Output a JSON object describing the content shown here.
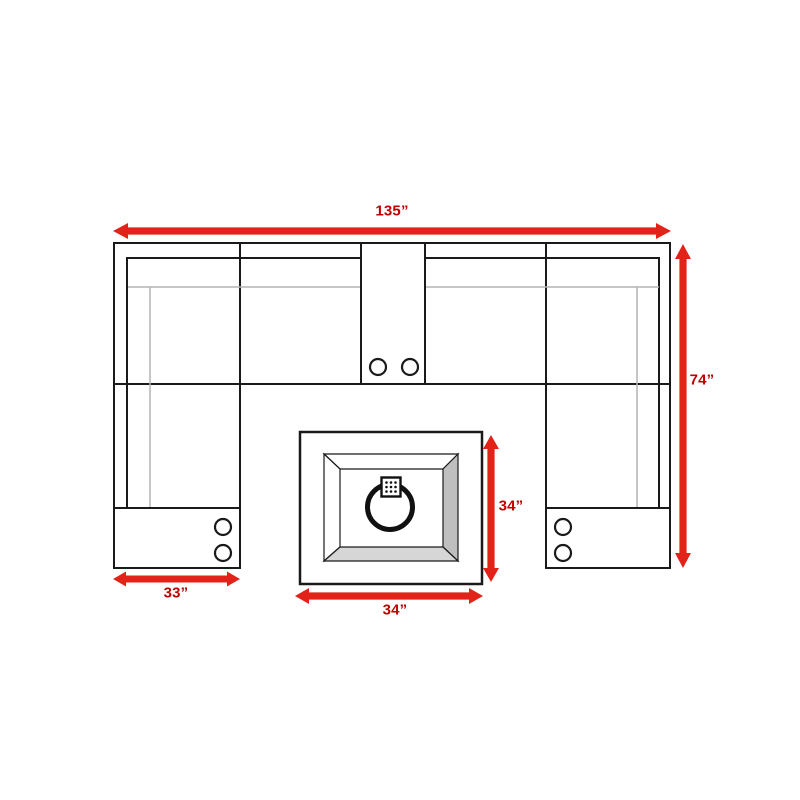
{
  "diagram": {
    "subject": "U-shaped sectional sofa floor plan with center fire pit table",
    "units": "inches",
    "colors": {
      "arrow_red": "#e2231a",
      "label_red": "#c00000",
      "outline_black": "#1a1a1a",
      "cushion_gray": "#b3b3b3",
      "bevel_right_gray": "#bfbfbf",
      "bevel_bottom_gray": "#d6d6d6"
    },
    "dimensions": {
      "overall_width": {
        "label": "135”",
        "value": 135
      },
      "overall_depth": {
        "label": "74”",
        "value": 74
      },
      "arm_width": {
        "label": "33”",
        "value": 33
      },
      "table_width": {
        "label": "34”",
        "value": 34
      },
      "table_depth": {
        "label": "34”",
        "value": 34
      }
    },
    "components": [
      "left-arm-console-with-two-cup-holders",
      "left-corner-seat",
      "middle-left-seat",
      "center-console-with-two-cup-holders",
      "middle-right-seat",
      "right-corner-seat",
      "right-arm-console-with-two-cup-holders",
      "square-fire-pit-table-with-ring-burner"
    ]
  }
}
